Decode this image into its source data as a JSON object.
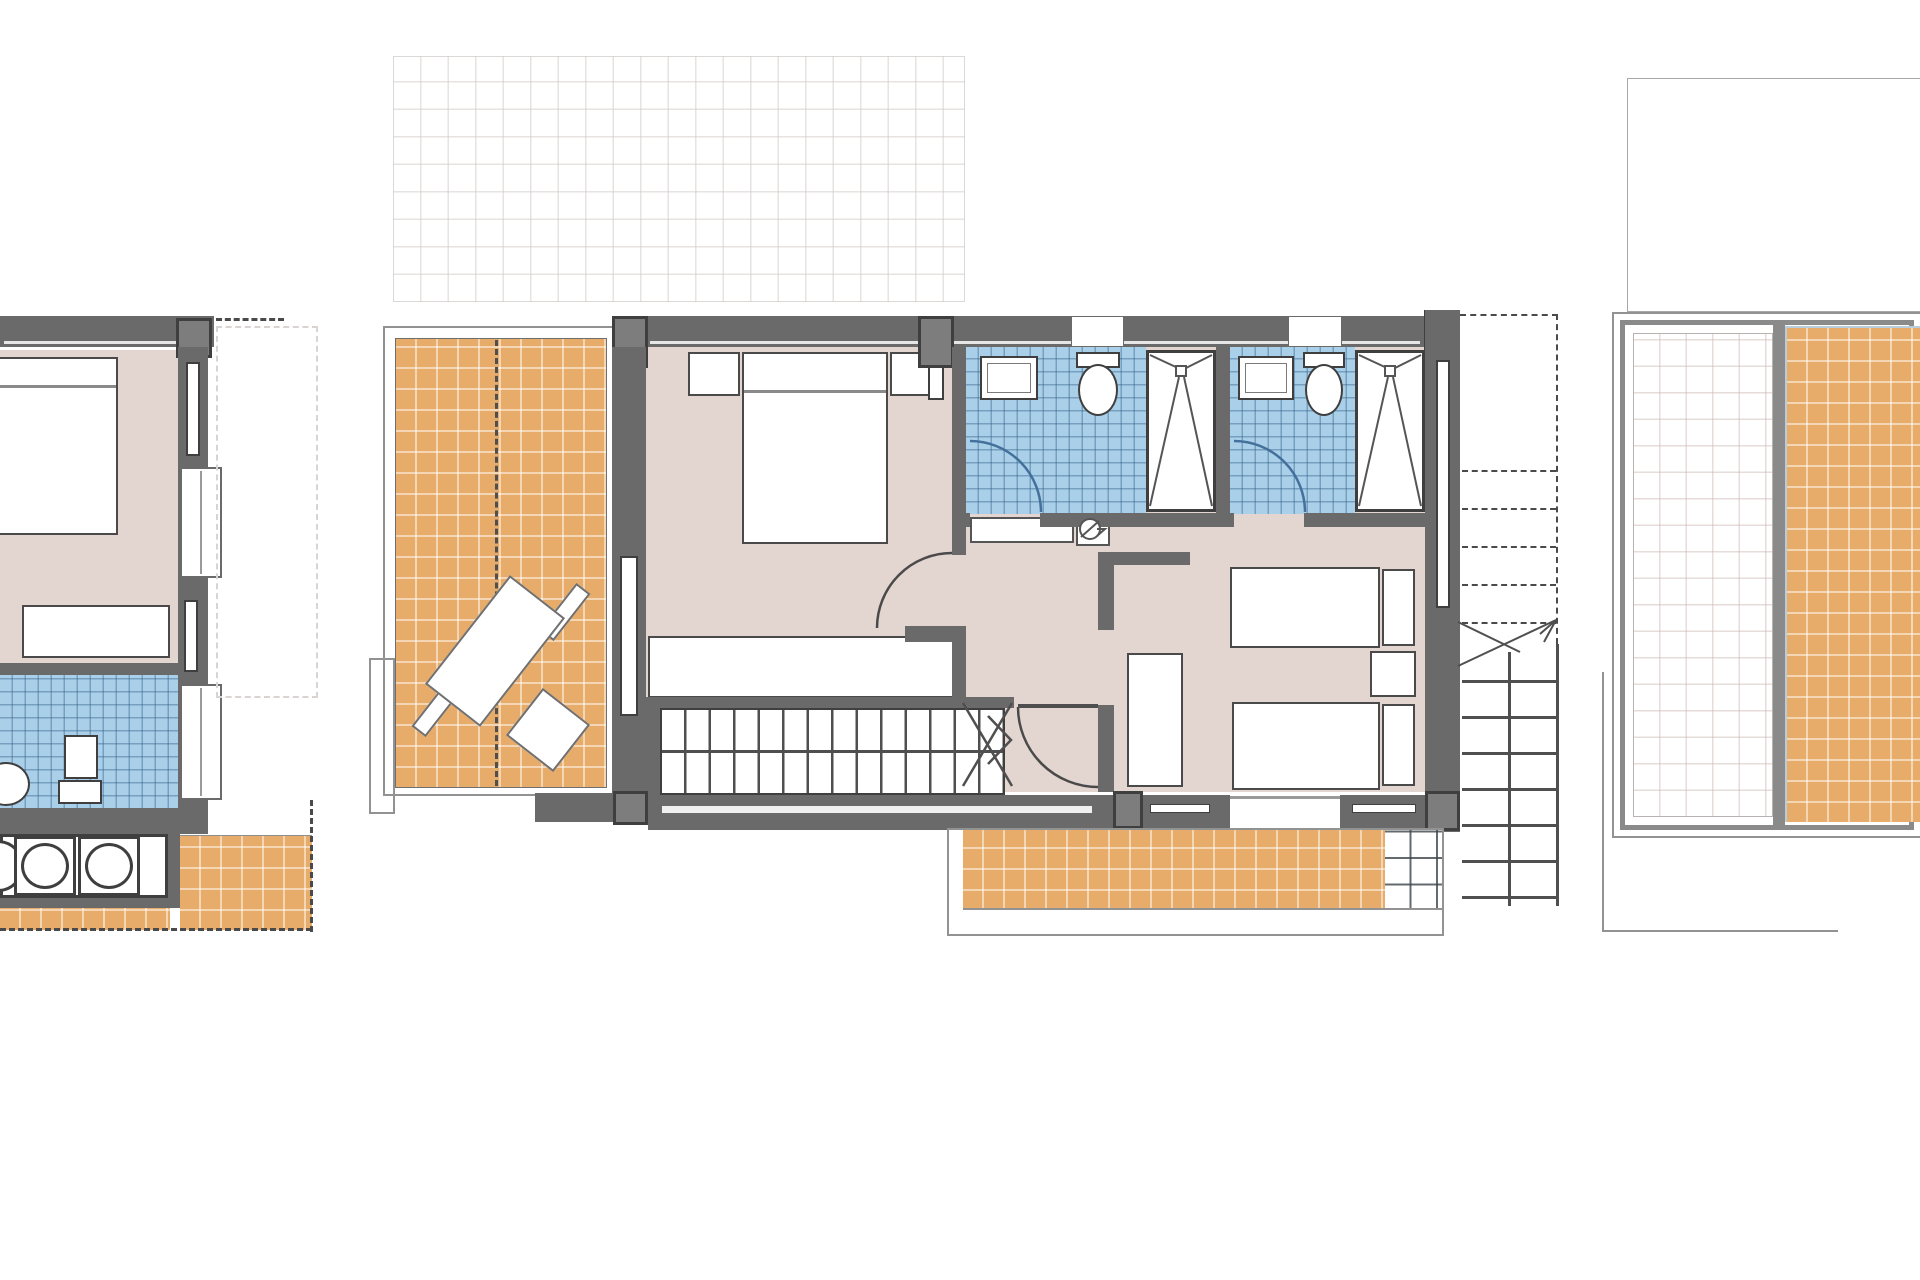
{
  "document": {
    "kind": "architectural-floor-plan",
    "floors_shown": 3,
    "visible_text": ""
  },
  "colors": {
    "wall": "#6a6a6a",
    "wall_dark": "#3f3f3f",
    "wall_column": "#7d7d7d",
    "floor_pink": "#e3d5d0",
    "tile_orange": "#e8ac6a",
    "tile_blue": "#aacfe9",
    "outline": "#929292",
    "dash": "#4a4a4a",
    "arc": "#4a4a4a",
    "arc_blue": "#44719b"
  },
  "plans": {
    "pergola": {
      "name": "pergola-roof-grid"
    },
    "left_unit_partial": {
      "rooms": [
        "bedroom",
        "bathroom",
        "kitchen-counter",
        "terrace"
      ],
      "fixtures": [
        "double-bed",
        "dresser",
        "wash-basin",
        "toilet",
        "cooktop-burners"
      ]
    },
    "main_floor": {
      "rooms": [
        "west-terrace",
        "master-bedroom",
        "bathroom-1",
        "bathroom-2",
        "hallway",
        "bedroom-2",
        "staircase",
        "south-terrace",
        "exterior-stair"
      ],
      "fixtures": [
        "sun-lounger",
        "double-bed",
        "nightstands",
        "wardrobe",
        "wash-basins",
        "toilets",
        "showers",
        "water-heater",
        "twin-beds",
        "closet"
      ]
    },
    "roof_plan_partial": {
      "rooms": [
        "roof-terrace-open",
        "roof-terrace-tiled"
      ]
    }
  }
}
